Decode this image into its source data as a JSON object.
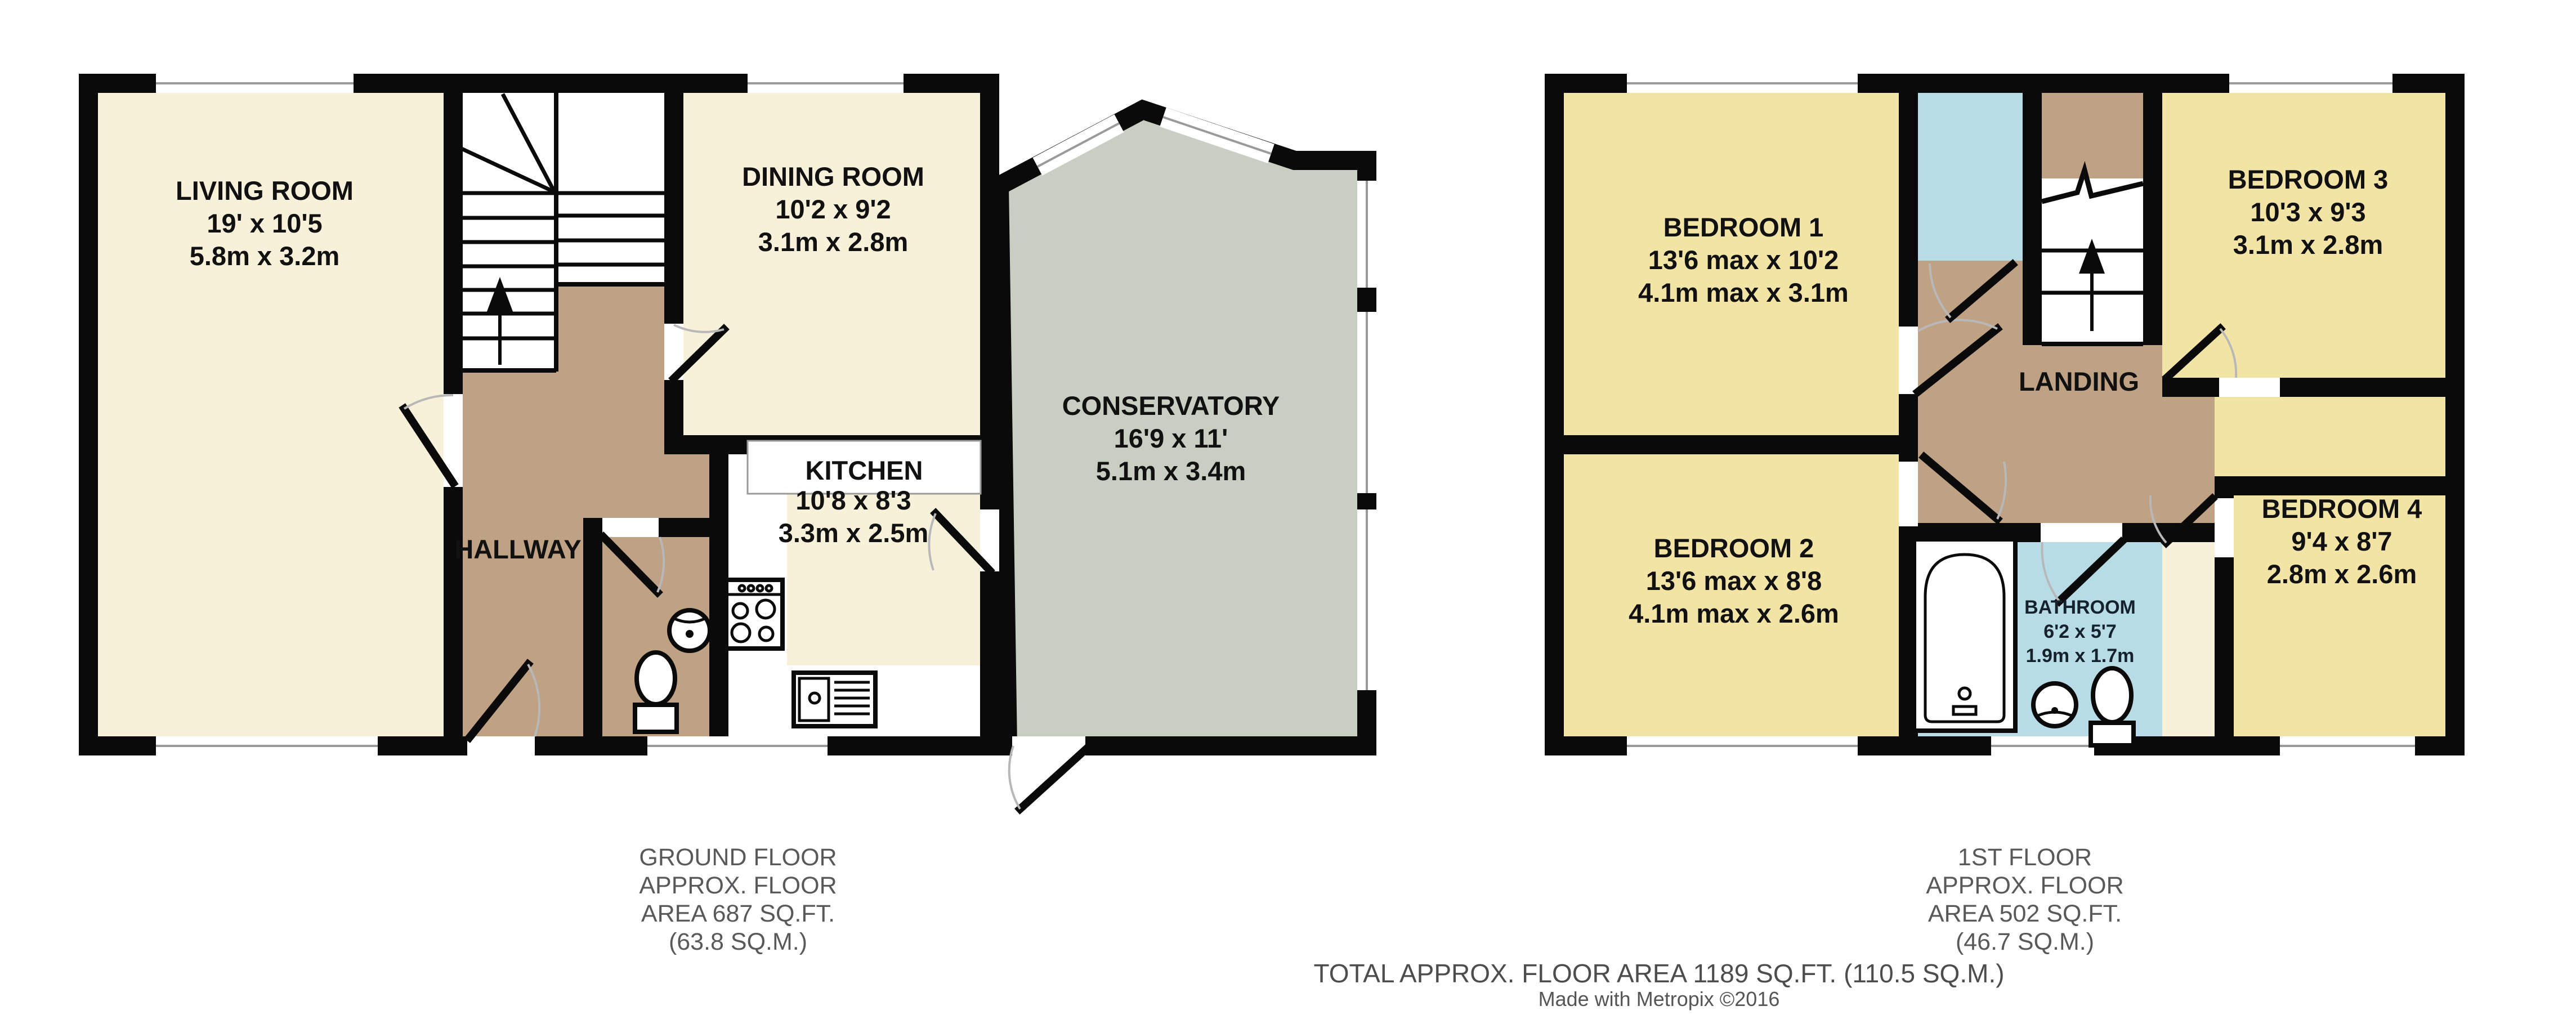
{
  "ground_floor": {
    "rooms": {
      "living_room": {
        "name": "LIVING ROOM",
        "imperial": "19' x 10'5",
        "metric": "5.8m x 3.2m"
      },
      "dining_room": {
        "name": "DINING ROOM",
        "imperial": "10'2 x 9'2",
        "metric": "3.1m x 2.8m"
      },
      "kitchen": {
        "name": "KITCHEN",
        "imperial": "10'8 x 8'3",
        "metric": "3.3m x 2.5m"
      },
      "conservatory": {
        "name": "CONSERVATORY",
        "imperial": "16'9 x 11'",
        "metric": "5.1m x 3.4m"
      },
      "hallway": {
        "name": "HALLWAY"
      }
    },
    "caption": [
      "GROUND FLOOR",
      "APPROX. FLOOR",
      "AREA 687 SQ.FT.",
      "(63.8 SQ.M.)"
    ]
  },
  "first_floor": {
    "rooms": {
      "bedroom_1": {
        "name": "BEDROOM 1",
        "imperial": "13'6 max x 10'2",
        "metric": "4.1m max x 3.1m"
      },
      "bedroom_2": {
        "name": "BEDROOM 2",
        "imperial": "13'6 max x 8'8",
        "metric": "4.1m max x 2.6m"
      },
      "bedroom_3": {
        "name": "BEDROOM 3",
        "imperial": "10'3 x 9'3",
        "metric": "3.1m x 2.8m"
      },
      "bedroom_4": {
        "name": "BEDROOM 4",
        "imperial": "9'4 x 8'7",
        "metric": "2.8m x 2.6m"
      },
      "bathroom": {
        "name": "BATHROOM",
        "imperial": "6'2 x 5'7",
        "metric": "1.9m x 1.7m"
      },
      "landing": {
        "name": "LANDING"
      }
    },
    "caption": [
      "1ST FLOOR",
      "APPROX. FLOOR",
      "AREA 502 SQ.FT.",
      "(46.7 SQ.M.)"
    ]
  },
  "footer": {
    "total": "TOTAL APPROX. FLOOR AREA 1189 SQ.FT. (110.5 SQ.M.)",
    "credit": "Made with Metropix ©2016"
  },
  "colors": {
    "room_cream": "#F8F1D9",
    "room_yellow": "#F2E4A4",
    "hall_tan": "#BFA184",
    "bath_blue": "#B7DCE5",
    "conservatory_green": "#C8CFC2",
    "wall": "#0A0A0A",
    "caption_gray": "#58595B"
  }
}
